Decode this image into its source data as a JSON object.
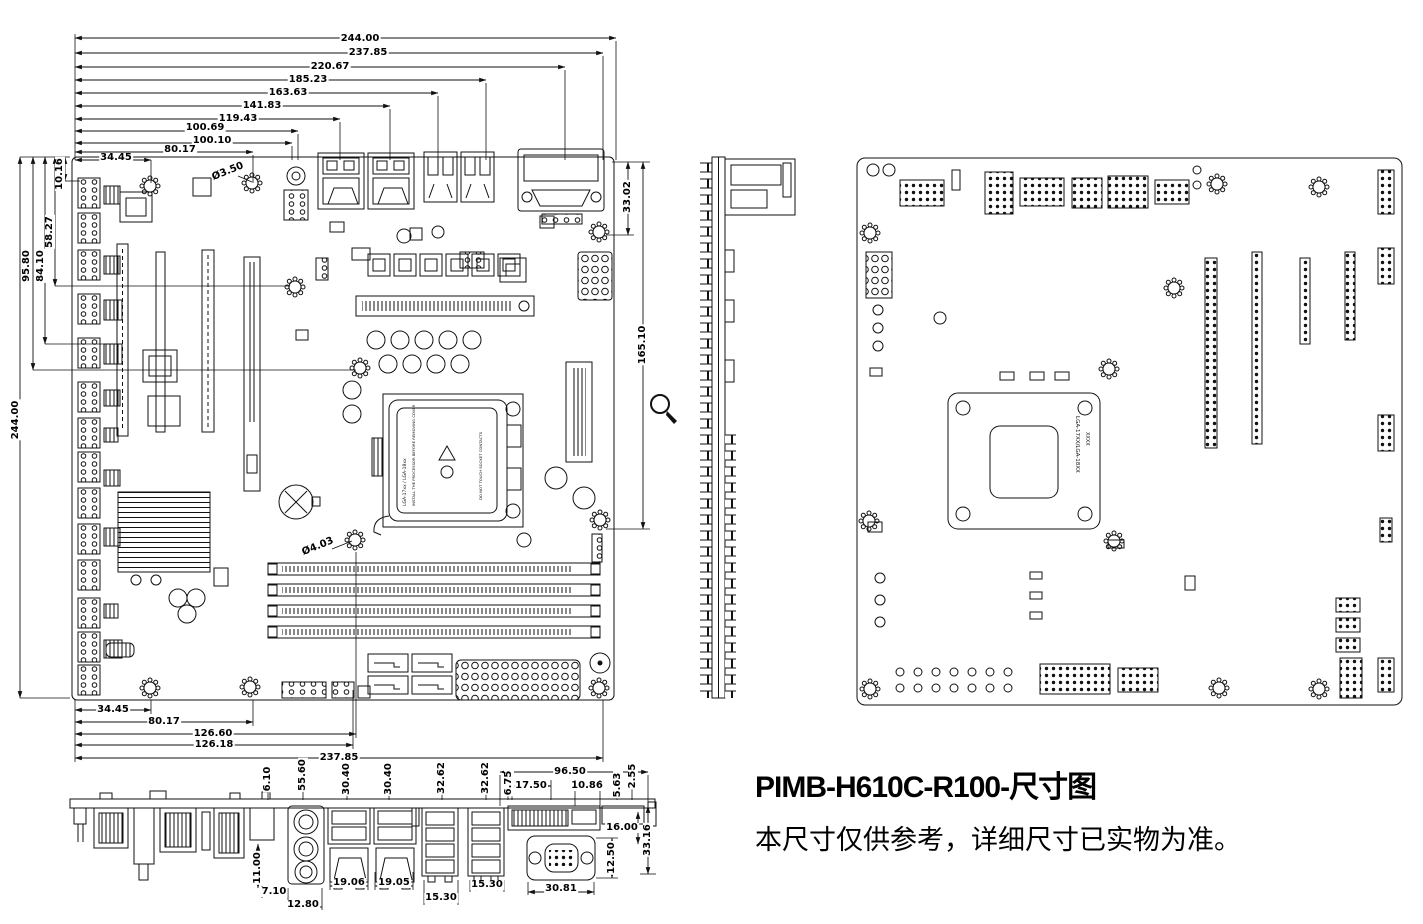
{
  "title": {
    "line1": "PIMB-H610C-R100-尺寸图",
    "line2": "本尺寸仅供参考，详细尺寸已实物为准。"
  },
  "dims": {
    "top": [
      "244.00",
      "237.85",
      "220.67",
      "185.23",
      "163.63",
      "141.83",
      "119.43",
      "100.69",
      "100.10",
      "80.17",
      "34.45"
    ],
    "left": [
      "10.16",
      "58.27",
      "95.80",
      "84.10",
      "244.00"
    ],
    "right": [
      "33.02",
      "165.10"
    ],
    "bottom": [
      "34.45",
      "80.17",
      "126.60",
      "126.18",
      "237.85"
    ],
    "holes": [
      "Ø3.50",
      "Ø4.03"
    ],
    "edge_top": [
      "6.10",
      "55.60",
      "30.40",
      "30.40",
      "32.62",
      "32.62",
      "6.75",
      "17.50",
      "96.50",
      "10.86",
      "5.63",
      "2.55"
    ],
    "edge_right": [
      "16.00",
      "12.50",
      "33.16"
    ],
    "edge_bottom": [
      "11.00",
      "7.10",
      "12.80",
      "19.06",
      "19.05",
      "15.30",
      "15.30",
      "30.81"
    ]
  },
  "socket": {
    "lga": "LGA-17xx / LGA-18xx",
    "warning": "INSTALL THE PROCESSOR BEFORE REMOVING COVER",
    "caution": "DO NOT TOUCH SOCKET CONTACTS"
  },
  "backplate": {
    "line1": "LGA-17XX/LGA-18XX",
    "line2": "XXXX"
  },
  "icons": {
    "magnifier": "magnifying-glass-cursor"
  }
}
